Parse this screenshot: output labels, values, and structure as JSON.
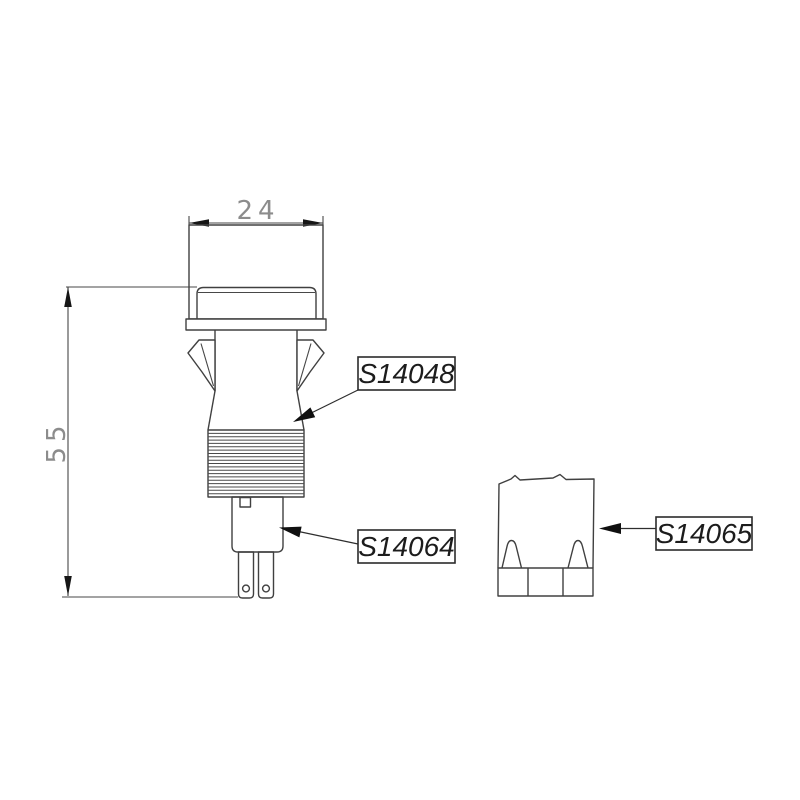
{
  "document": {
    "type": "technical-drawing",
    "subject": "panel-mount push button switch with snap-in clips, threaded bushing, spade terminals and lens cap",
    "background": "#ffffff"
  },
  "colors": {
    "line": "#404040",
    "dimension_line": "#474747",
    "dimension_text": "#8c8c8c",
    "label_text": "#1c1c1c",
    "label_box_border": "#2b2b2b",
    "arrow_fill": "#101010"
  },
  "dimensions": {
    "cap_width": "24",
    "total_height": "55"
  },
  "part_labels": {
    "clip_bushing": "S14048",
    "switch_base": "S14064",
    "lens_cap": "S14065"
  }
}
